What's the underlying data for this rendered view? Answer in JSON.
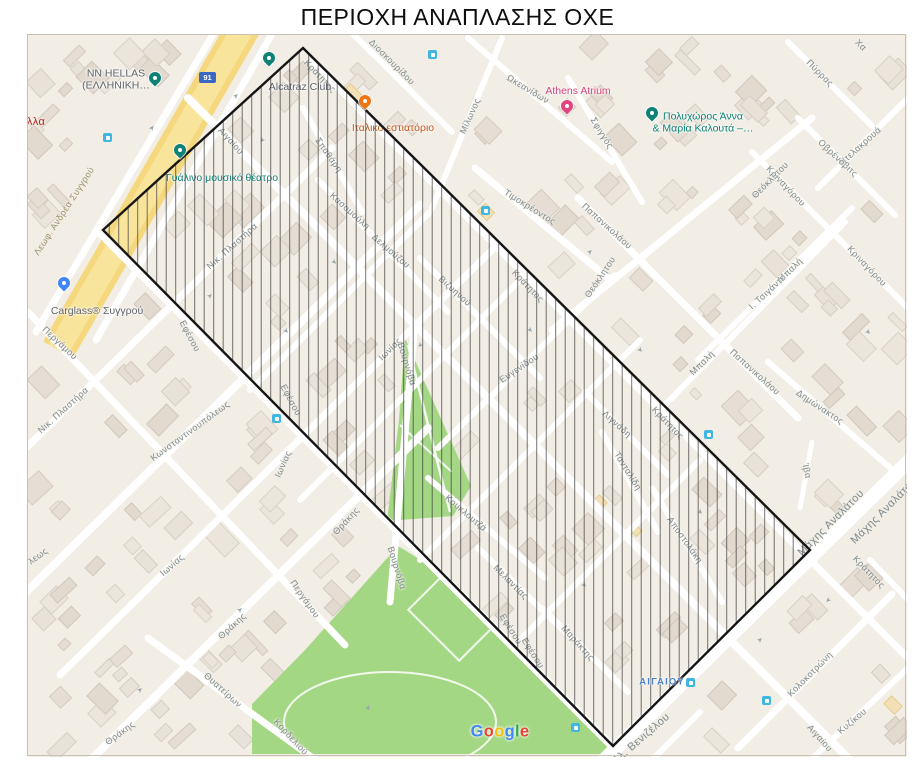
{
  "title": "ΠΕΡΙΟΧΗ ΑΝΑΠΛΑΣΗΣ ΟΧΕ",
  "attribution": "Google",
  "road_badge": "91",
  "station_label": "ΑΙΓΑΙΟΥ",
  "colors": {
    "map_base": "#f2ede5",
    "park_green": "#a4d784",
    "road_yellow": "#f5d87d",
    "accent_teal": "#0f8276",
    "poi_orange": "#ee7512",
    "poi_pink": "#e1447f",
    "poi_blue": "#4285f4",
    "transit_blue": "#41b6e0",
    "hatch_line": "#3c3c3c",
    "polygon_outline": "#151515",
    "label_grey": "#7c8a8c"
  },
  "polygon_points": "303,48 810,550 613,746 103,230",
  "pois": [
    {
      "name": "nn-hellas",
      "lines": [
        "NN HELLAS",
        "(ΕΛΛΗΝΙΚΗ…"
      ],
      "label_x": 116,
      "label_y": 80,
      "pin": "teal",
      "pin_x": 155,
      "pin_y": 84,
      "text_color": "#5f6368"
    },
    {
      "name": "alcatraz-club",
      "lines": [
        "Alcatraz Club"
      ],
      "label_x": 300,
      "label_y": 87,
      "pin": "teal",
      "pin_x": 269,
      "pin_y": 64,
      "text_color": "#5f6368"
    },
    {
      "name": "gyalino-mousiko-theatro",
      "lines": [
        "Γυάλινο μουσικό θέατρο"
      ],
      "label_x": 222,
      "label_y": 178,
      "pin": "teal",
      "pin_x": 180,
      "pin_y": 156,
      "text_color": "#0f8276"
    },
    {
      "name": "italiko-estiatorio",
      "lines": [
        "Ιταλικό εστιατόριο"
      ],
      "label_x": 393,
      "label_y": 128,
      "pin": "orange",
      "pin_x": 365,
      "pin_y": 107,
      "text_color": "#c75514"
    },
    {
      "name": "athens-atrium",
      "lines": [
        "Athens Atrium"
      ],
      "label_x": 578,
      "label_y": 91,
      "pin": "pink",
      "pin_x": 567,
      "pin_y": 112,
      "text_color": "#d6447c"
    },
    {
      "name": "polychoros-anna-maria-kalouta",
      "lines": [
        "Πολυχώρος Άννα",
        "& Μαρία Καλουτά –…"
      ],
      "label_x": 703,
      "label_y": 123,
      "pin": "teal",
      "pin_x": 652,
      "pin_y": 119,
      "text_color": "#0f8276"
    },
    {
      "name": "carglass-syggrou",
      "lines": [
        "Carglass® Συγγρού"
      ],
      "label_x": 97,
      "label_y": 311,
      "pin": "blue",
      "pin_x": 64,
      "pin_y": 289,
      "text_color": "#5f6368"
    }
  ],
  "street_labels": [
    {
      "t": "Λεωφ. Ανδρέα Συγγρού",
      "x": 64,
      "y": 211,
      "r": -57,
      "c": "#9a8f66"
    },
    {
      "t": "αι",
      "x": 20,
      "y": 62,
      "r": 0,
      "c": "#4a4a4a",
      "s": 11
    },
    {
      "t": "κολλα",
      "x": 30,
      "y": 122,
      "r": 0,
      "c": "#c5221f",
      "s": 11
    },
    {
      "t": "Αιγαίου",
      "x": 231,
      "y": 141,
      "r": 48
    },
    {
      "t": "Σπαθάρη",
      "x": 329,
      "y": 155,
      "r": 55
    },
    {
      "t": "Διοσκουρίδου",
      "x": 392,
      "y": 62,
      "r": 45
    },
    {
      "t": "Μίλωνος",
      "x": 470,
      "y": 116,
      "r": -66
    },
    {
      "t": "Ωκεανίδων",
      "x": 528,
      "y": 89,
      "r": 31
    },
    {
      "t": "Σφιγγός",
      "x": 602,
      "y": 133,
      "r": 58
    },
    {
      "t": "Πύρρας",
      "x": 820,
      "y": 73,
      "r": 45
    },
    {
      "t": "Χα",
      "x": 861,
      "y": 45,
      "r": 45
    },
    {
      "t": "Ντελακρουά",
      "x": 860,
      "y": 146,
      "r": -42
    },
    {
      "t": "Οβρένοβιτς",
      "x": 838,
      "y": 158,
      "r": 43
    },
    {
      "t": "Τιμοκρέοντος",
      "x": 530,
      "y": 207,
      "r": 32
    },
    {
      "t": "Παπανικολάου",
      "x": 607,
      "y": 226,
      "r": 42
    },
    {
      "t": "Παπανικολάου",
      "x": 755,
      "y": 372,
      "r": 42
    },
    {
      "t": "Θεόκλητου",
      "x": 600,
      "y": 277,
      "r": -56
    },
    {
      "t": "Θεόκλητου",
      "x": 770,
      "y": 180,
      "r": -45
    },
    {
      "t": "Κριναγόρου",
      "x": 786,
      "y": 186,
      "r": 46
    },
    {
      "t": "Κριναγόρου",
      "x": 867,
      "y": 266,
      "r": 46
    },
    {
      "t": "Μπαλή",
      "x": 790,
      "y": 270,
      "r": -44
    },
    {
      "t": "Μπαλή",
      "x": 702,
      "y": 363,
      "r": -44
    },
    {
      "t": "Ι. Τσιγάντε",
      "x": 767,
      "y": 292,
      "r": -43
    },
    {
      "t": "Κράτητος",
      "x": 320,
      "y": 76,
      "r": 46
    },
    {
      "t": "Κράτητος",
      "x": 528,
      "y": 286,
      "r": 46
    },
    {
      "t": "Κράτητος",
      "x": 668,
      "y": 423,
      "r": 46
    },
    {
      "t": "Κράτητος",
      "x": 869,
      "y": 572,
      "r": 46
    },
    {
      "t": "Νικ. Πλαστήρα",
      "x": 232,
      "y": 246,
      "r": -42
    },
    {
      "t": "Νικ. Πλαστήρα",
      "x": 63,
      "y": 410,
      "r": -42
    },
    {
      "t": "Κασομούλη",
      "x": 350,
      "y": 211,
      "r": 42
    },
    {
      "t": "Δελμούζου",
      "x": 391,
      "y": 251,
      "r": 41
    },
    {
      "t": "Βιζυηνού",
      "x": 455,
      "y": 291,
      "r": 42
    },
    {
      "t": "Εφέσου",
      "x": 190,
      "y": 336,
      "r": 62
    },
    {
      "t": "Εφέσου",
      "x": 291,
      "y": 400,
      "r": 62
    },
    {
      "t": "Εφέσου",
      "x": 511,
      "y": 629,
      "r": 58
    },
    {
      "t": "Εφέσου",
      "x": 533,
      "y": 653,
      "r": 58
    },
    {
      "t": "Περγάμου",
      "x": 60,
      "y": 343,
      "r": 43
    },
    {
      "t": "Περγάμου",
      "x": 305,
      "y": 599,
      "r": 55
    },
    {
      "t": "Κωνσταντινουπόλεως",
      "x": 190,
      "y": 431,
      "r": -36
    },
    {
      "t": "λεως",
      "x": 38,
      "y": 556,
      "r": -36
    },
    {
      "t": "Ιωνίας",
      "x": 390,
      "y": 349,
      "r": -45
    },
    {
      "t": "Ιωνίας",
      "x": 283,
      "y": 464,
      "r": -66
    },
    {
      "t": "Ιωνίας",
      "x": 172,
      "y": 565,
      "r": -41
    },
    {
      "t": "Θράκης",
      "x": 346,
      "y": 521,
      "r": -47
    },
    {
      "t": "Θράκης",
      "x": 232,
      "y": 626,
      "r": -42
    },
    {
      "t": "Θράκης",
      "x": 120,
      "y": 733,
      "r": -36
    },
    {
      "t": "Θυατείρων",
      "x": 223,
      "y": 690,
      "r": 42
    },
    {
      "t": "Κορδελιού",
      "x": 291,
      "y": 737,
      "r": 47
    },
    {
      "t": "Βουρνόβα",
      "x": 407,
      "y": 364,
      "r": 73
    },
    {
      "t": "Βουρνόβα",
      "x": 397,
      "y": 568,
      "r": 73
    },
    {
      "t": "Ευγενίδου",
      "x": 519,
      "y": 368,
      "r": -34
    },
    {
      "t": "Κουκλουτζά",
      "x": 466,
      "y": 513,
      "r": 40
    },
    {
      "t": "Μελαντίας",
      "x": 511,
      "y": 582,
      "r": 45
    },
    {
      "t": "Μαράκτης",
      "x": 578,
      "y": 643,
      "r": 48
    },
    {
      "t": "Λιγνάδη",
      "x": 617,
      "y": 424,
      "r": 42
    },
    {
      "t": "Τανταλίδη",
      "x": 628,
      "y": 471,
      "r": 58
    },
    {
      "t": "Αποστολάκη",
      "x": 685,
      "y": 540,
      "r": 55
    },
    {
      "t": "Δημώνακτος",
      "x": 820,
      "y": 407,
      "r": 34
    },
    {
      "t": "Ίβα",
      "x": 807,
      "y": 471,
      "r": 78
    },
    {
      "t": "Μάχης Αναλάτου",
      "x": 831,
      "y": 523,
      "r": -45,
      "s": 11
    },
    {
      "t": "Μάχης Αναλάτου",
      "x": 884,
      "y": 511,
      "r": -45,
      "s": 11
    },
    {
      "t": "Ελ. Βενιζέλου",
      "x": 641,
      "y": 739,
      "r": -41,
      "s": 11
    },
    {
      "t": "Κολοκοτρώνη",
      "x": 810,
      "y": 674,
      "r": -45
    },
    {
      "t": "Κυζίκου",
      "x": 852,
      "y": 721,
      "r": -40
    },
    {
      "t": "Αιγαίου",
      "x": 820,
      "y": 738,
      "r": 48
    }
  ],
  "transit_icons": [
    [
      432,
      54
    ],
    [
      485,
      210
    ],
    [
      107,
      137
    ],
    [
      276,
      418
    ],
    [
      708,
      434
    ],
    [
      766,
      700
    ],
    [
      575,
      727
    ],
    [
      690,
      682
    ]
  ],
  "badge_pos": [
    207,
    77
  ],
  "station_pos": [
    662,
    682
  ],
  "google_pos": [
    500,
    732
  ],
  "google_colors": [
    "#4285F4",
    "#EA4335",
    "#FBBC05",
    "#4285F4",
    "#34A853",
    "#EA4335"
  ],
  "arrows": [
    [
      152,
      128,
      -57
    ],
    [
      236,
      96,
      -45
    ],
    [
      262,
      140,
      135
    ],
    [
      334,
      262,
      45
    ],
    [
      286,
      331,
      45
    ],
    [
      210,
      296,
      -45
    ],
    [
      420,
      345,
      135
    ],
    [
      530,
      330,
      45
    ],
    [
      590,
      252,
      -45
    ],
    [
      640,
      350,
      45
    ],
    [
      700,
      512,
      45
    ],
    [
      584,
      585,
      45
    ],
    [
      760,
      640,
      -45
    ],
    [
      828,
      600,
      135
    ],
    [
      868,
      332,
      45
    ],
    [
      240,
      610,
      -45
    ],
    [
      140,
      690,
      -45
    ],
    [
      368,
      708,
      45
    ]
  ]
}
